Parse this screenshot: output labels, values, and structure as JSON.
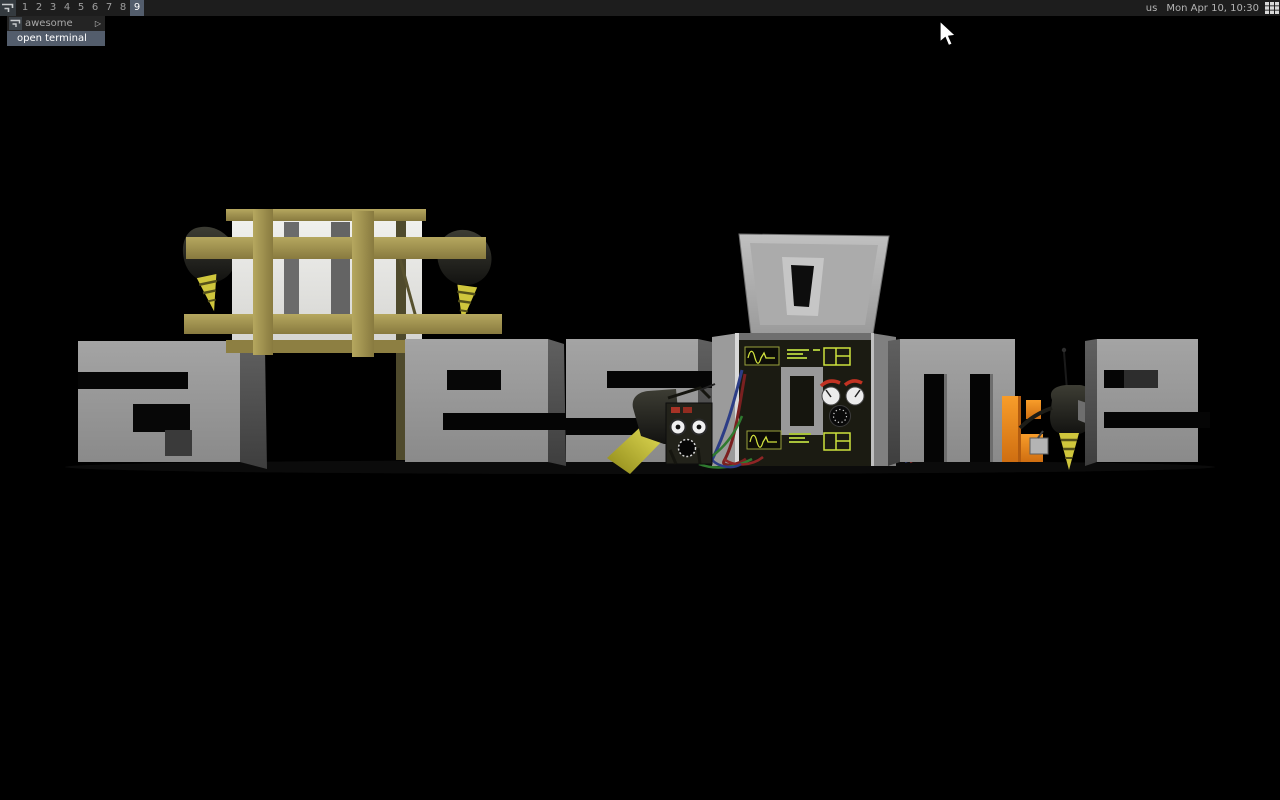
{
  "wallpaper": {
    "word": "awesome",
    "background": "#000000",
    "elements": [
      "letter-a",
      "crated-letter-w",
      "letter-e",
      "letter-s",
      "machine-letter-o",
      "inspector-robot",
      "letter-m",
      "orange-letter-piece",
      "installer-robot",
      "letter-e-final"
    ]
  },
  "bar": {
    "launcher_icon": "awesome-logo-icon",
    "tags": [
      "1",
      "2",
      "3",
      "4",
      "5",
      "6",
      "7",
      "8",
      "9"
    ],
    "selected_tag": "9",
    "keyboard_layout": "us",
    "clock": "Mon Apr 10, 10:30",
    "layout_icon": "fair-grid-layout-icon"
  },
  "menu": {
    "items": [
      {
        "label": "awesome",
        "has_submenu": true
      },
      {
        "label": "open terminal",
        "focused": true
      }
    ],
    "submenu_arrow": "▷"
  },
  "colors": {
    "bar_bg": "#1d1d1d",
    "fg_normal": "#9e9e9e",
    "fg_focus": "#ffffff",
    "bg_focus": "#535d6c",
    "menu_bg": "#242424",
    "letter_gray": "#9a9a9a",
    "crate_wood": "#a89a55",
    "robot_black": "#1f1f1a",
    "drill_yellow": "#d6ce3e",
    "orange_piece": "#ee8512",
    "panel_green": "#cde23c",
    "wire_blue": "#2c3d86",
    "wire_red": "#7a2020",
    "wire_green": "#2f7a2f"
  }
}
